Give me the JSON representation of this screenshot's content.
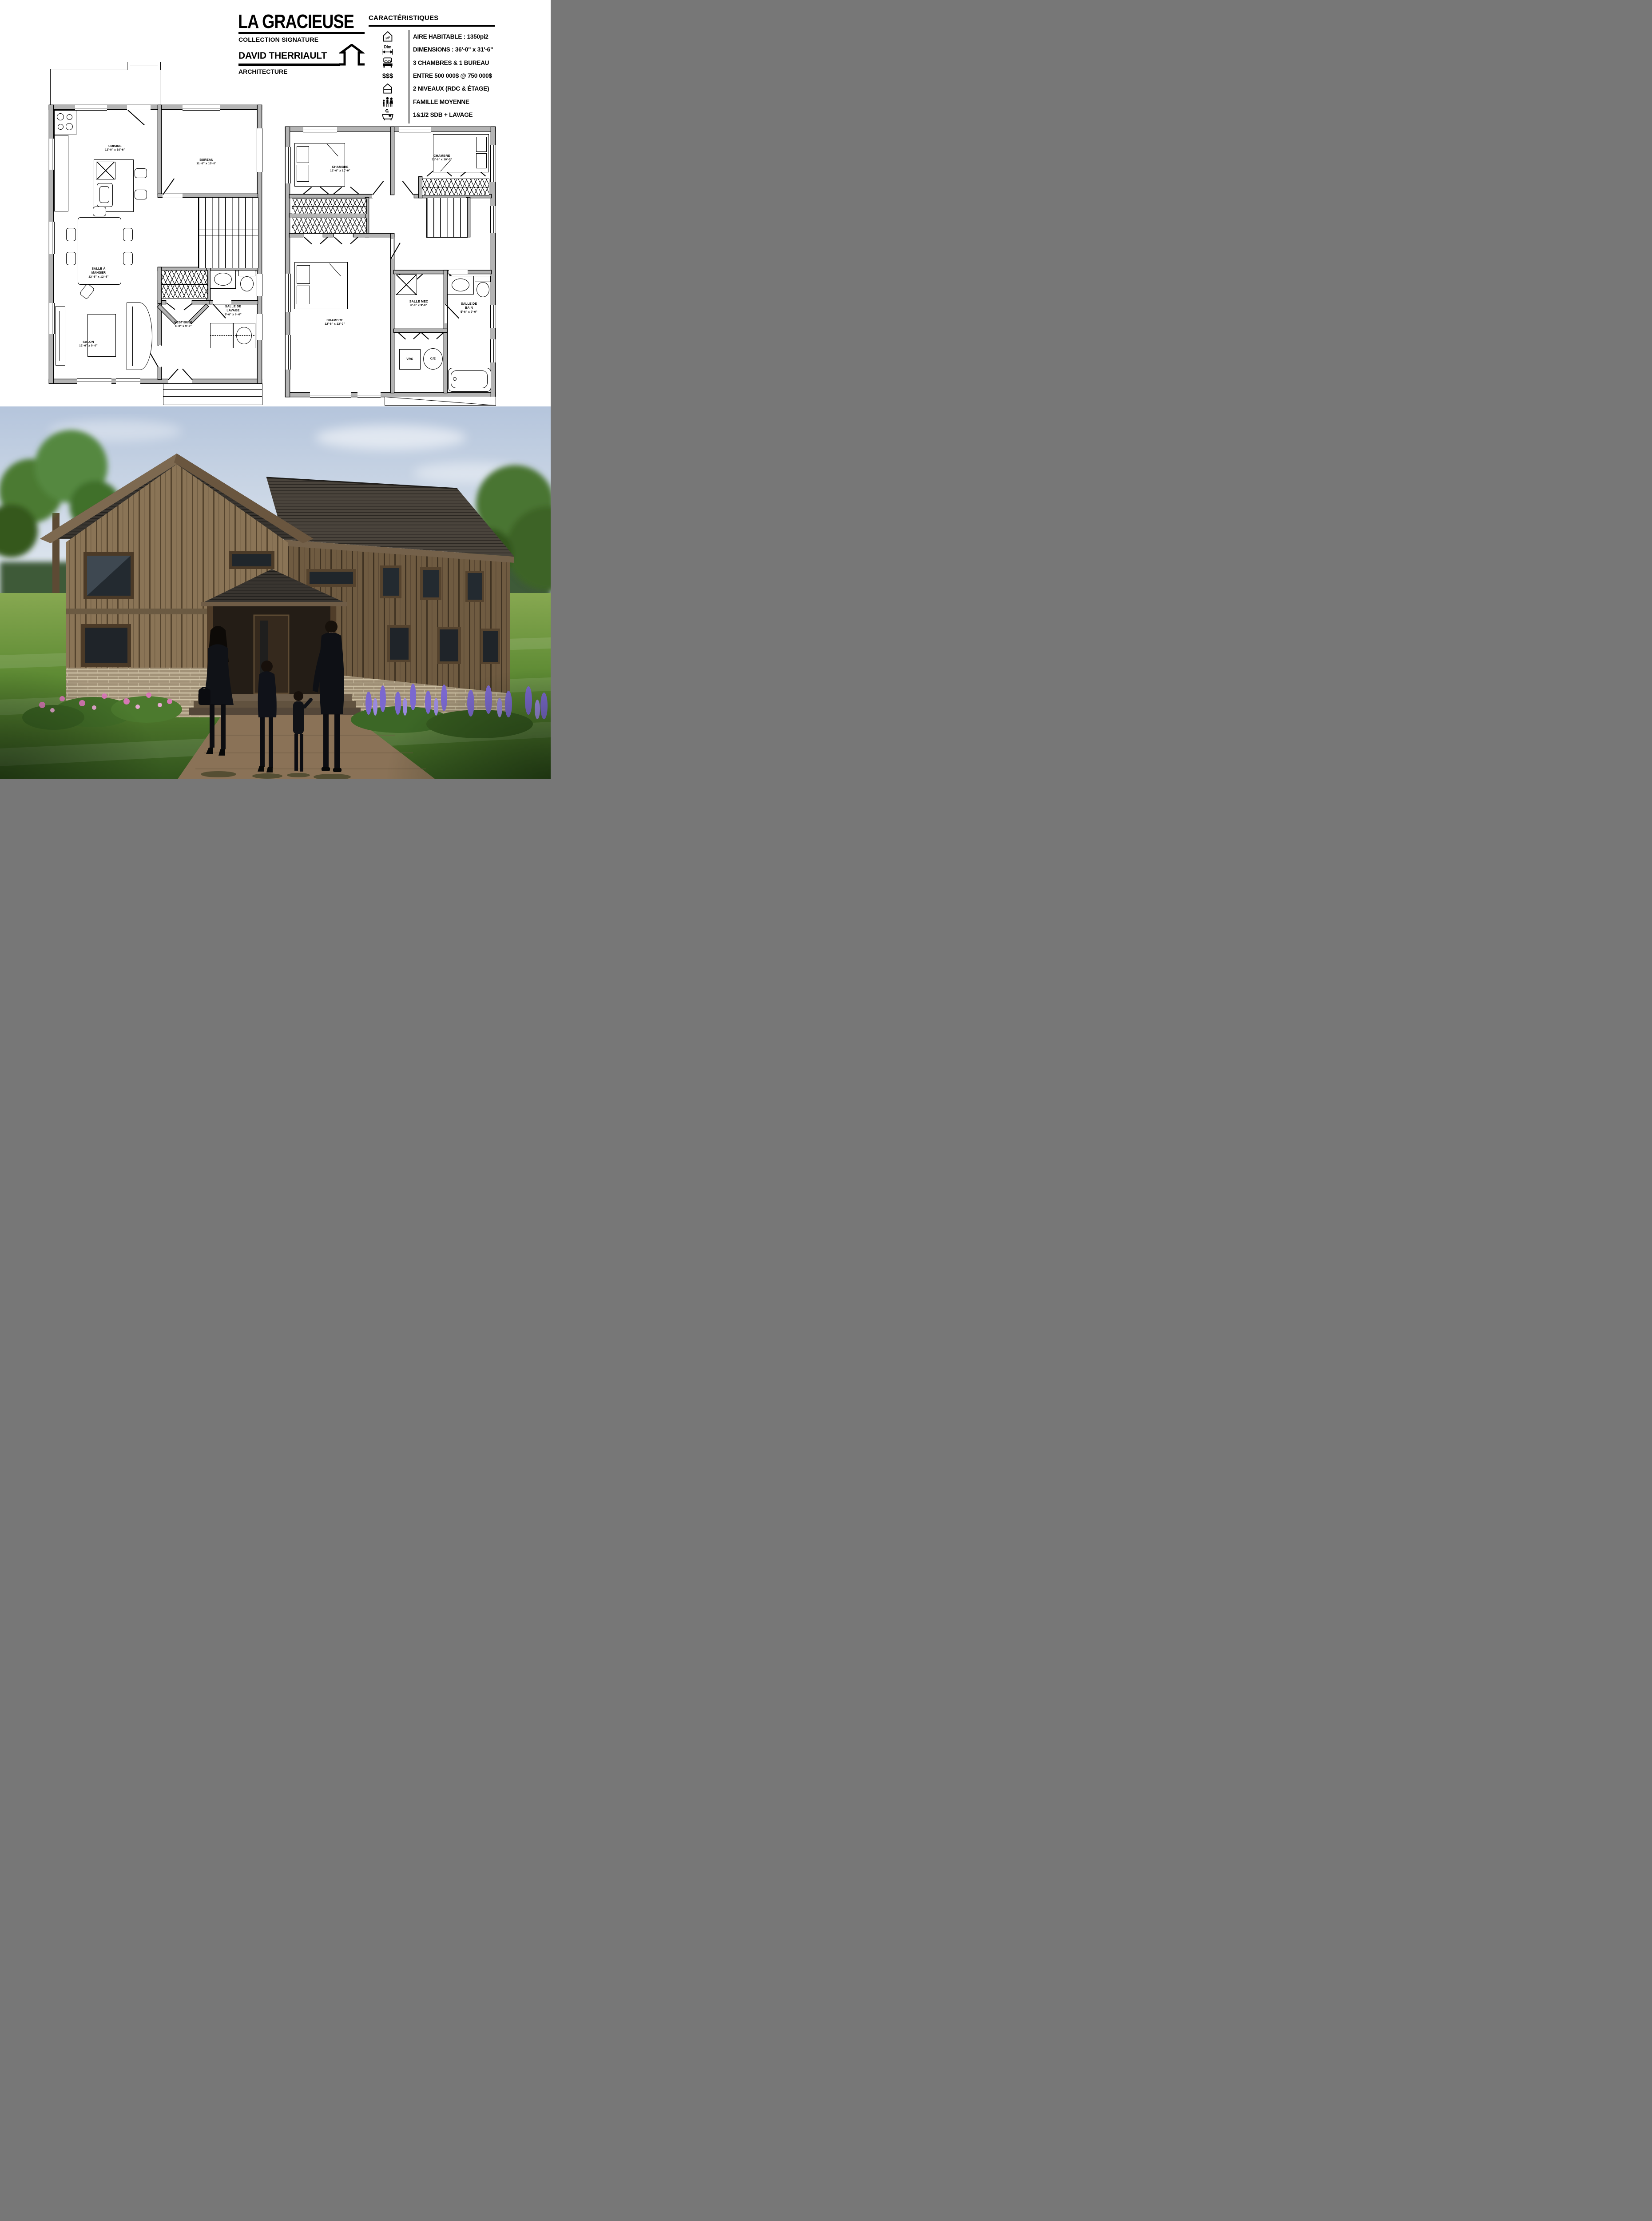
{
  "sheet": {
    "title_block": {
      "title": "LA GRACIEUSE",
      "subtitle": "COLLECTION SIGNATURE",
      "author": "DAVID THERRIAULT",
      "profession": "ARCHITECTURE"
    },
    "characteristics": {
      "header": "CARACTÉRISTIQUES",
      "rows": [
        {
          "icon": "area-house-icon",
          "icon_label": "pi²",
          "text": "AIRE HABITABLE : 1350pi2"
        },
        {
          "icon": "dimensions-icon",
          "icon_label": "Dim",
          "text": "DIMENSIONS : 36'-0\" x 31'-6\""
        },
        {
          "icon": "bed-icon",
          "text": "3 CHAMBRES & 1 BUREAU"
        },
        {
          "icon": "price-icon",
          "icon_label": "$$$",
          "text": "ENTRE 500 000$ @ 750 000$"
        },
        {
          "icon": "two-storey-house-icon",
          "text": "2 NIVEAUX (RDC & ÉTAGE)"
        },
        {
          "icon": "family-icon",
          "text": "FAMILLE MOYENNE"
        },
        {
          "icon": "bathtub-icon",
          "text": "1&1/2 SDB + LAVAGE"
        }
      ]
    }
  },
  "plans": {
    "ground": {
      "rooms": [
        {
          "name": "CUISINE",
          "dims": "12'-0\" x 10'-6\""
        },
        {
          "name": "BUREAU",
          "dims": "11'-6\" x 10'-0\""
        },
        {
          "name": "SALLE À MANGER",
          "dims": "12'-6\" x 12'-6\""
        },
        {
          "name": "VESTIBULE",
          "dims": "6'-0\" x 9'-0\""
        },
        {
          "name": "SALLE DE LAVAGE",
          "dims": "5'-6\" x 9'-0\""
        },
        {
          "name": "SALON",
          "dims": "12'-6\" x 9'-0\""
        }
      ]
    },
    "upper": {
      "rooms": [
        {
          "name": "CHAMBRE",
          "dims": "12'-6\" x 10'-0\""
        },
        {
          "name": "CHAMBRE",
          "dims": "11'-6\" x 10'-0\""
        },
        {
          "name": "CHAMBRE",
          "dims": "12'-6\" x 13'-0\""
        },
        {
          "name": "SALLE MEC",
          "dims": "6'-0\" x 9'-0\""
        },
        {
          "name": "SALLE DE BAIN",
          "dims": "5'-6\" x 9'-0\""
        }
      ],
      "equipment": {
        "vrc": "VRC",
        "chauffe_eau": "C/E"
      }
    }
  },
  "render": {
    "palette": {
      "sky": "#bcc9dd",
      "roof_shingles": "#36322d",
      "siding_light": "#8a7456",
      "siding_dark": "#6f5b41",
      "stone_base": "#a29278",
      "lawn": "#5d8a33",
      "lavender": "#7b68cf",
      "pink_flowers": "#d678b4",
      "family_clothing": "#101217"
    }
  }
}
